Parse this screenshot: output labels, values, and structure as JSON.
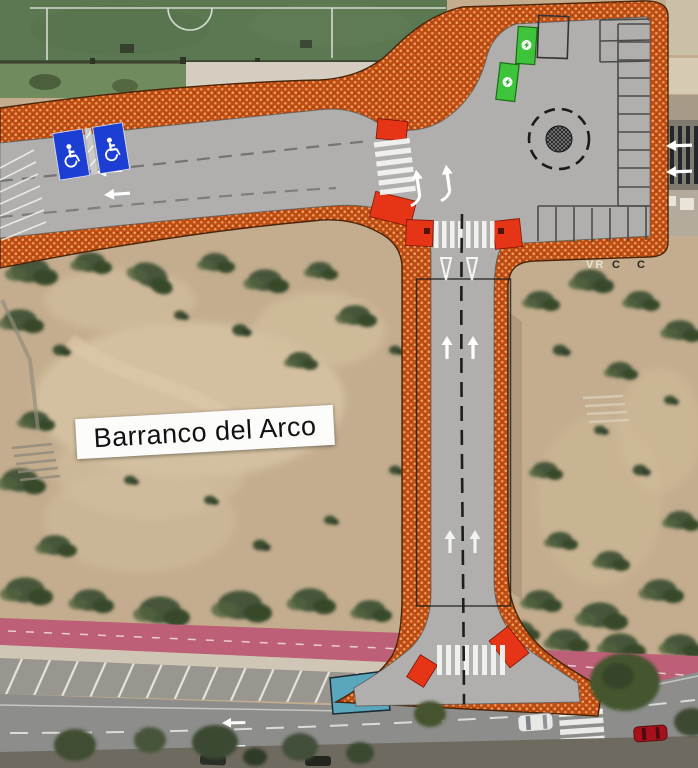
{
  "map": {
    "area_label": "Barranco del Arco",
    "ground_text_left": "VR",
    "ground_text_right": "C C",
    "features": {
      "disabled_parking_spaces": 2,
      "green_parking_spaces": 2,
      "roundabout": true,
      "crosswalks": 4,
      "cars_on_street": 2
    },
    "colors": {
      "sidewalk_hatch_orange": "#bf4e14",
      "curb_red": "#e63417",
      "disabled_parking_blue": "#1c3ed2",
      "green_space": "#3ec43b",
      "bike_lane_pink": "#bd5f76",
      "reserved_zone_teal": "#5aa7bd",
      "road_gray": "#b0afad",
      "field_green": "#5c7853",
      "terrain_sand": "#c3ad8e"
    }
  }
}
